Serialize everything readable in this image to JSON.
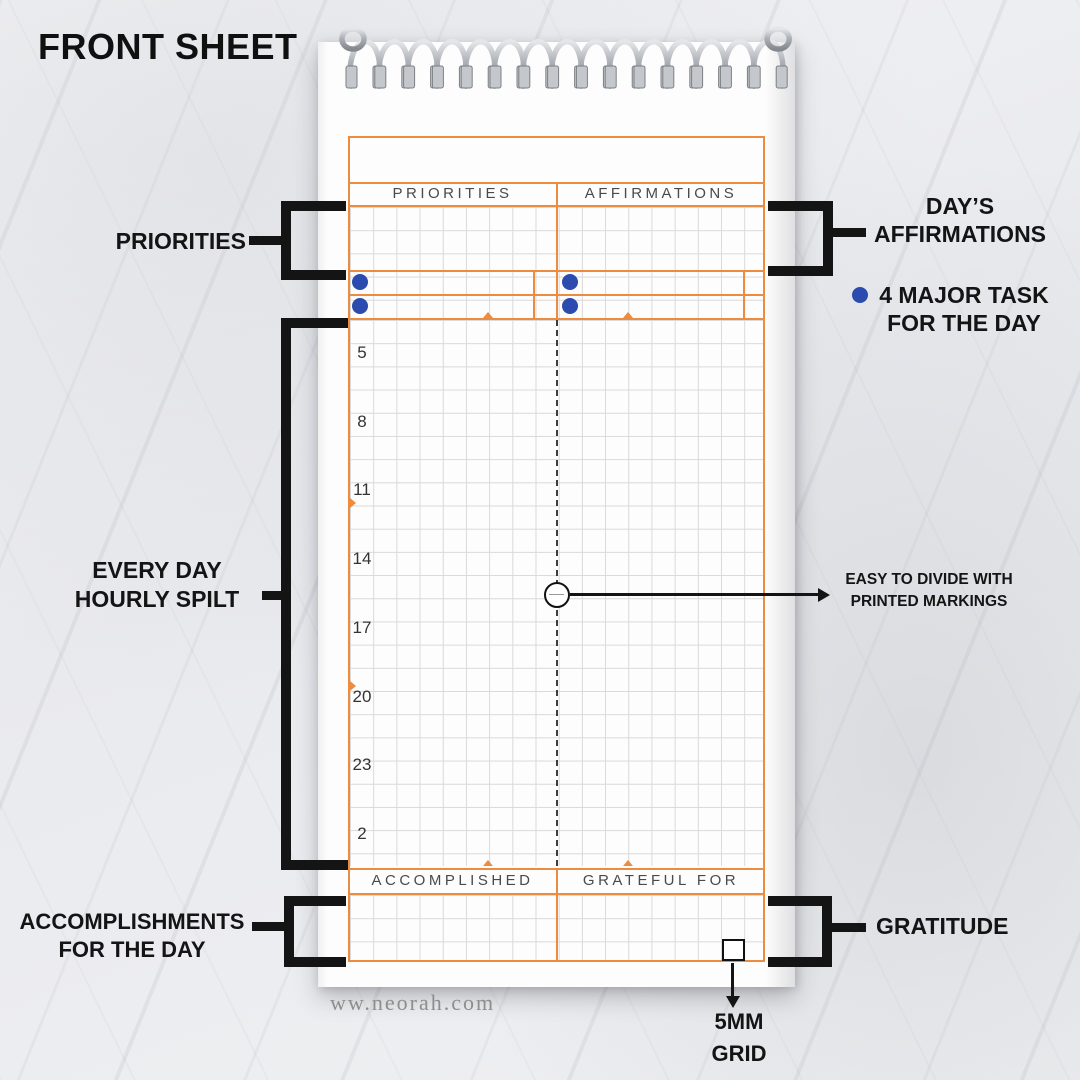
{
  "title": "FRONT SHEET",
  "watermark": "ww.neorah.com",
  "sheet": {
    "headers": {
      "left": "PRIORITIES",
      "right": "AFFIRMATIONS"
    },
    "footers": {
      "left": "ACCOMPLISHED",
      "right": "GRATEFUL FOR"
    },
    "hours": [
      "5",
      "8",
      "11",
      "14",
      "17",
      "20",
      "23",
      "2"
    ]
  },
  "annotations": {
    "priorities": "PRIORITIES",
    "affirmations_line1": "DAY’S",
    "affirmations_line2": "AFFIRMATIONS",
    "major_task_line1": "4 MAJOR TASK",
    "major_task_line2": "FOR THE DAY",
    "hourly_line1": "EVERY DAY",
    "hourly_line2": "HOURLY SPILT",
    "divide_line1": "EASY TO DIVIDE WITH",
    "divide_line2": "PRINTED MARKINGS",
    "accomplishments_line1": "ACCOMPLISHMENTS",
    "accomplishments_line2": "FOR THE DAY",
    "gratitude": "GRATITUDE",
    "grid_line1": "5MM",
    "grid_line2": "GRID"
  },
  "colors": {
    "orange": "#ED8B3F",
    "blue": "#2B4BAE",
    "black": "#141414",
    "grid_gray": "#d9d9d9"
  }
}
